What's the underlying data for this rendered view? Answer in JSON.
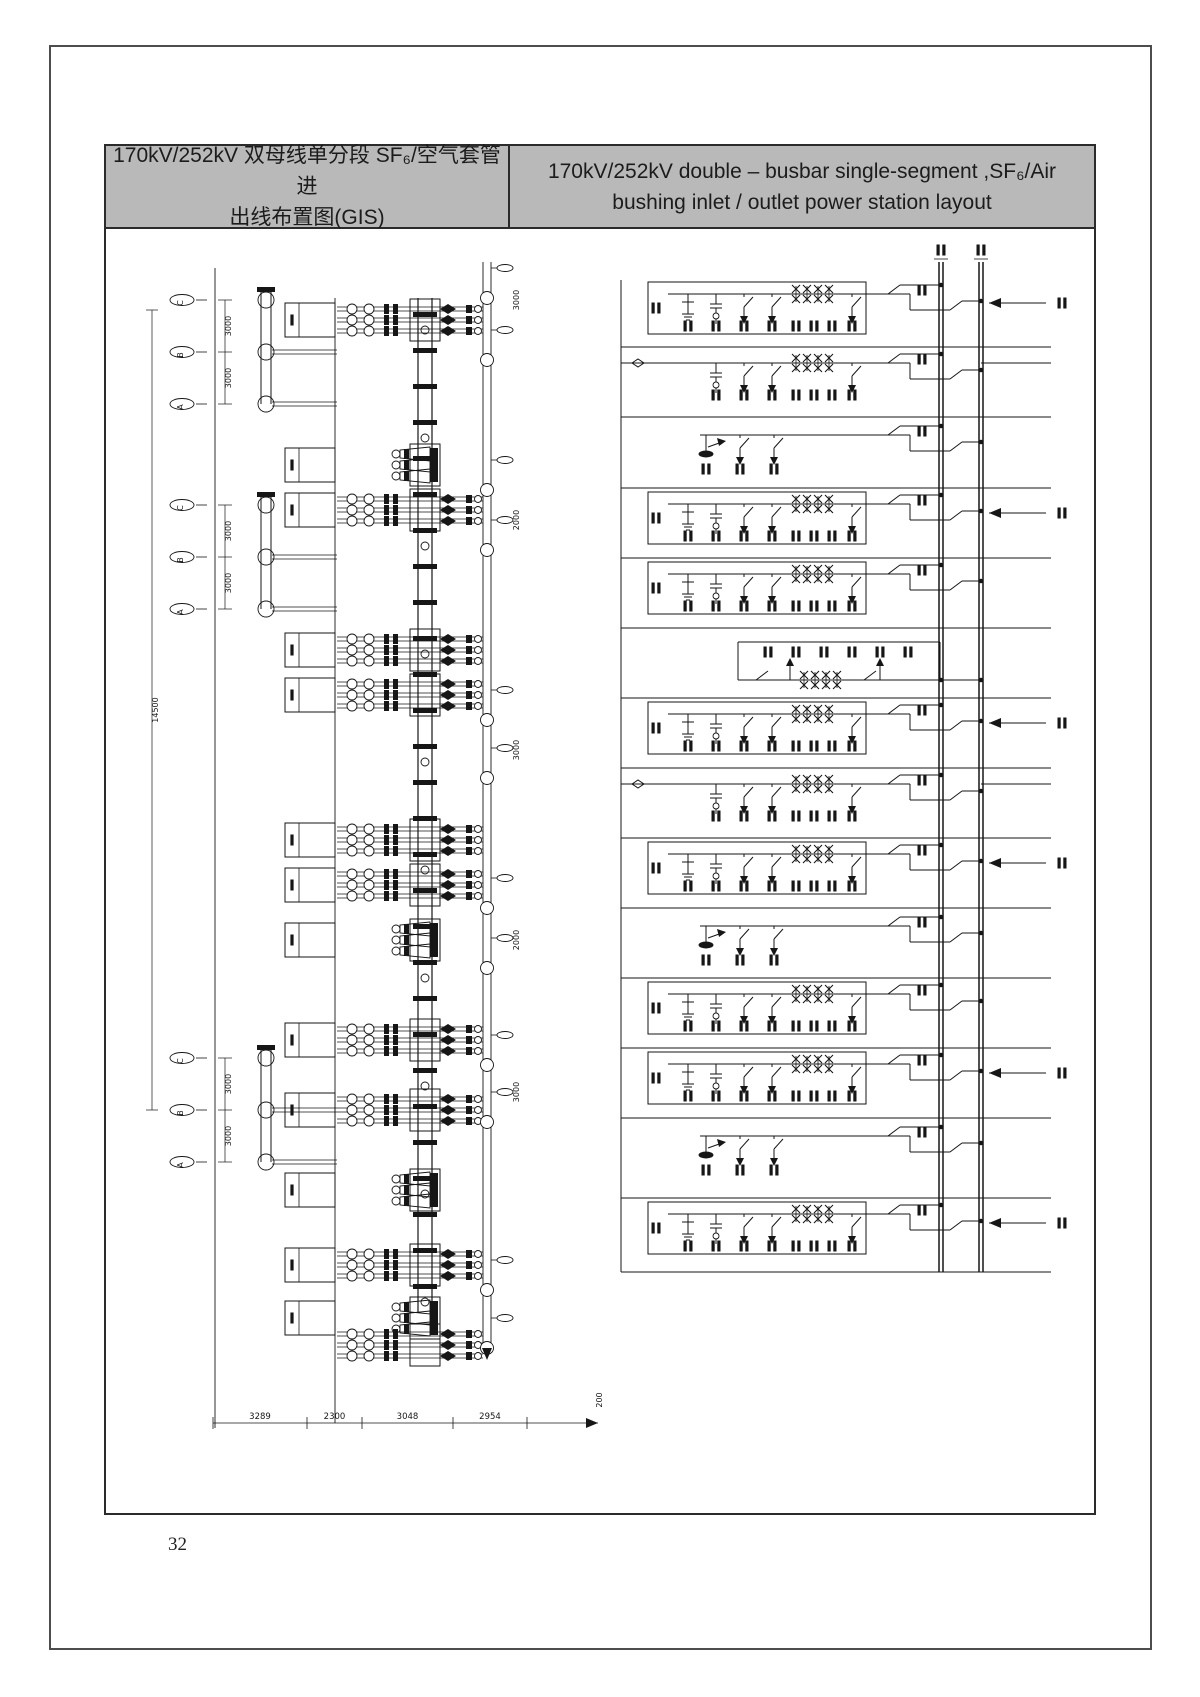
{
  "header": {
    "left_title_lines": [
      "170kV/252kV 双母线单分段 SF₆/空气套管进",
      "出线布置图(GIS)"
    ],
    "right_title_lines": [
      "170kV/252kV double – busbar single-segment ,SF₆/Air",
      "bushing inlet / outlet power station layout"
    ]
  },
  "page": {
    "number": "32"
  },
  "drawing": {
    "left_plan": {
      "phase_labels": [
        "C",
        "B",
        "A"
      ],
      "phase_gap_dim": "3000",
      "overall_height_dim": "14500",
      "bottom_dim_chain": [
        "3289",
        "2300",
        "3048",
        "2954"
      ],
      "side_dims": [
        "3000",
        "2000",
        "3000",
        "2000",
        "3000",
        "200"
      ],
      "phase_assembly_y": [
        300,
        505,
        1058
      ],
      "bays": [
        {
          "y": 320,
          "kind": "run"
        },
        {
          "y": 465,
          "kind": "cone"
        },
        {
          "y": 510,
          "kind": "run"
        },
        {
          "y": 650,
          "kind": "run"
        },
        {
          "y": 695,
          "kind": "run"
        },
        {
          "y": 840,
          "kind": "run"
        },
        {
          "y": 885,
          "kind": "run"
        },
        {
          "y": 940,
          "kind": "cone"
        },
        {
          "y": 1040,
          "kind": "run"
        },
        {
          "y": 1110,
          "kind": "run"
        },
        {
          "y": 1190,
          "kind": "cone"
        },
        {
          "y": 1265,
          "kind": "run"
        },
        {
          "y": 1318,
          "kind": "cone"
        },
        {
          "y": 1345,
          "kind": "run",
          "nobox": true
        }
      ]
    },
    "right_schematic": {
      "busbar_count": 2,
      "rows": [
        "line-boxed-outgoing",
        "line-open",
        "pt-earthing",
        "line-boxed-outgoing",
        "line-boxed",
        "bus-coupler",
        "line-boxed-outgoing",
        "line-open",
        "line-boxed-outgoing",
        "pt-earthing",
        "line-boxed",
        "line-boxed-outgoing",
        "pt-earthing",
        "line-boxed-outgoing"
      ]
    }
  }
}
